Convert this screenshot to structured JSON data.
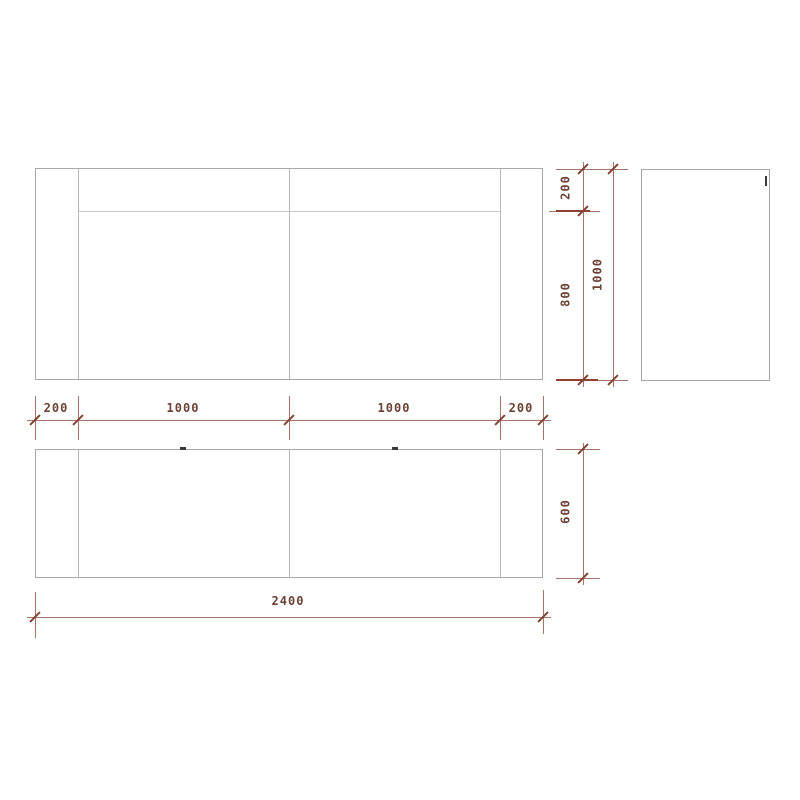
{
  "drawing": {
    "type": "furniture-three-view-technical-drawing",
    "colors": {
      "background": "#ffffff",
      "outline_gray": "#a8a8a8",
      "inner_line_gray": "#c6c6c6",
      "dimension_line": "#a1756a",
      "dimension_tick": "#82422f",
      "dimension_text": "#6b4136",
      "handle_mark": "#3a3a3a"
    },
    "icons": {
      "plan_handle_left": "door-handle-mark",
      "plan_handle_right": "door-handle-mark",
      "side_handle": "door-handle-mark"
    },
    "dimensions": {
      "top_segments": [
        "200",
        "1000",
        "1000",
        "200"
      ],
      "height_segments": [
        "200",
        "800"
      ],
      "height_total": "1000",
      "depth": "600",
      "width_total": "2400"
    }
  }
}
